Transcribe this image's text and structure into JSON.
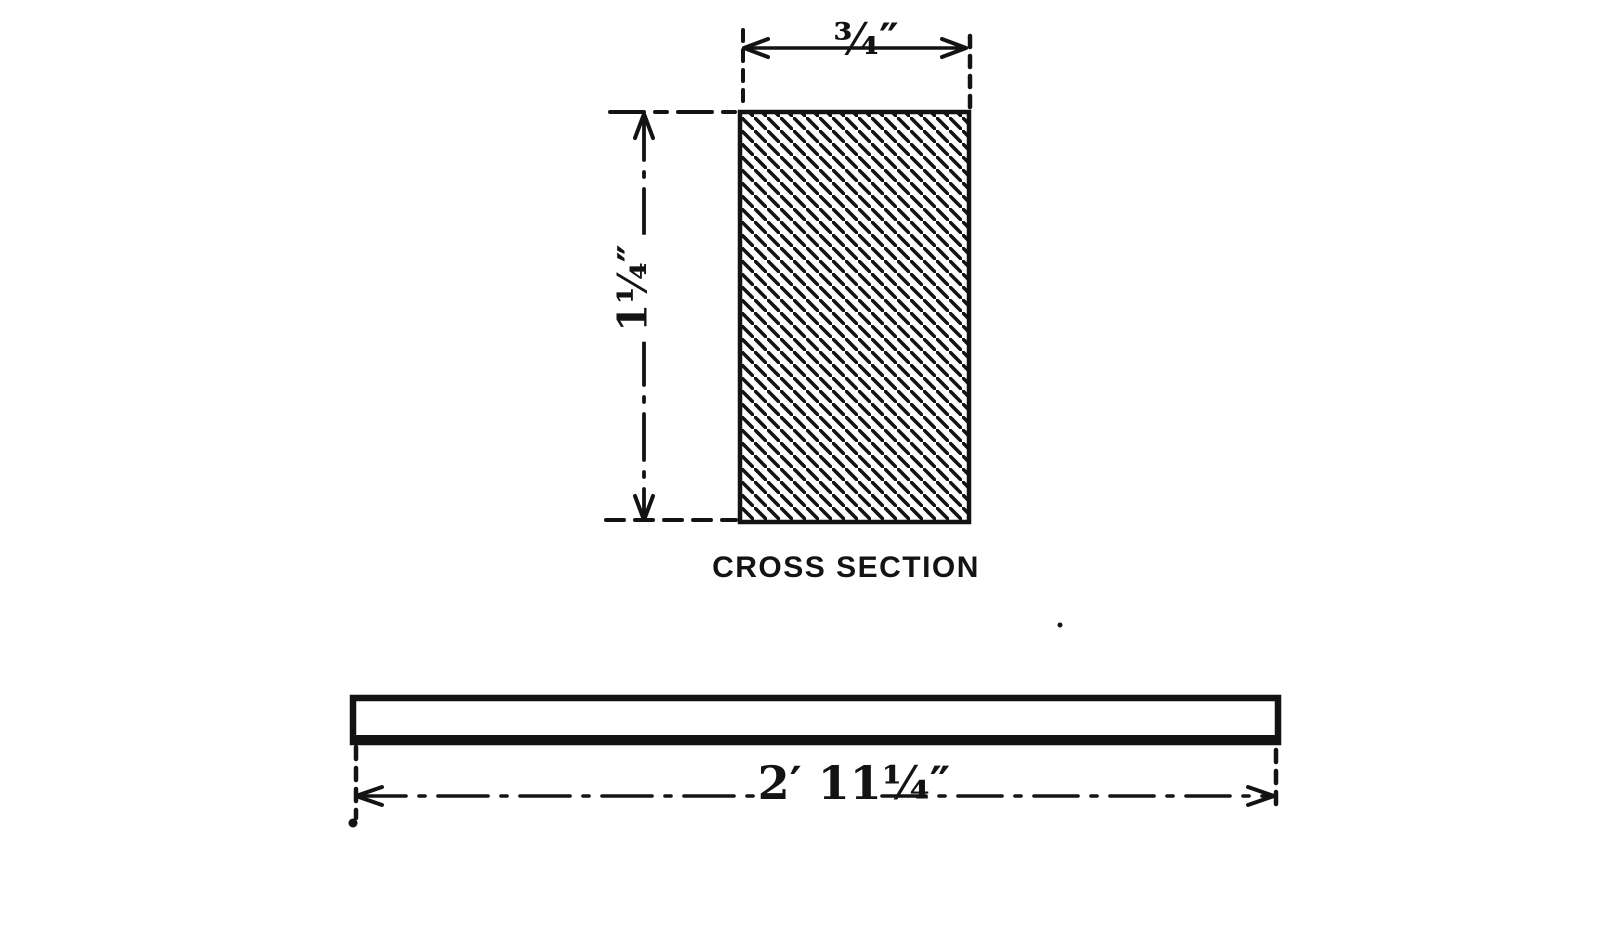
{
  "page": {
    "background": "#ffffff",
    "ink": "#131313"
  },
  "cross_section": {
    "width_label": "¾″",
    "height_label": "1¼″",
    "caption": "CROSS SECTION"
  },
  "side_view": {
    "length_label": "2′ 11¼″"
  }
}
